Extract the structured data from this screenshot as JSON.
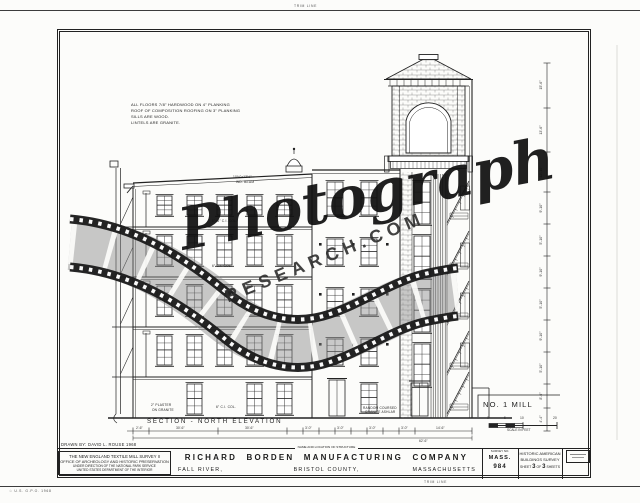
{
  "colors": {
    "ink": "#222222",
    "paper": "#fcfcfa",
    "film_gray": "#8a8a8a"
  },
  "watermark": {
    "script": "Photograph",
    "domain": "RESEARCH.COM"
  },
  "trim": {
    "top_label": "TRIM LINE",
    "bottom_label": "TRIM LINE",
    "printer_note": "☆ U.S. G.P.O. 1968"
  },
  "notes": {
    "line1": "ALL FLOORS 7/8\" HARDWOOD ON 4\" PLANKING",
    "line2": "ROOF OF COMPOSITION ROOFING ON 3\" PLANKING",
    "line3": "SILLS ARE WOOD.",
    "line4": "LINTELS ARE GRANITE."
  },
  "drawing": {
    "section_label": "SECTION - NORTH ELEVATION",
    "mill_label": "NO. 1 MILL",
    "scale": {
      "caption": "SCALE IN FEET",
      "t0": "0",
      "t1": "5",
      "t2": "10",
      "t3": "20"
    },
    "ann": {
      "beam1": "10½\"x13½\"",
      "beam2": "WD. BEAM",
      "col_a": "6\"x6\" C.I. COL.",
      "col_b": "6\" C.I. COL.",
      "col_c": "6\" C.I. COL.",
      "plaster1": "2\" PLASTER",
      "plaster2": "ON GRANITE",
      "ashlar1": "RANDOM COURSED",
      "ashlar2": "GRANITE ASHLAR"
    },
    "dims": {
      "bottom": [
        "2'-6\"",
        "30'-6\"",
        "30'-6\"",
        "3'-0\"",
        "3'-0\"",
        "3'-0\"",
        "3'-0\"",
        "14'-6\""
      ],
      "bottom_total": "62'-6\"",
      "right": [
        "15'-6\"",
        "13'-6\"",
        "12'-10\"",
        "9'-10\"",
        "5'-10\"",
        "9'-10\"",
        "5'-10\"",
        "9'-10\"",
        "5'-10\"",
        "8'-6\"",
        "4'-4\""
      ]
    }
  },
  "titleblock": {
    "drawn_by": "DRAWN BY:  DAVID L. ROUSE  1968",
    "agency": {
      "l1": "THE NEW ENGLAND TEXTILE MILL SURVEY II",
      "l2": "OFFICE OF ARCHEOLOGY AND HISTORIC PRESERVATION",
      "l3": "UNDER DIRECTION OF THE NATIONAL PARK SERVICE",
      "l4": "UNITED STATES DEPARTMENT OF THE INTERIOR"
    },
    "name_header": "NAME AND LOCATION OF STRUCTURE",
    "structure_name": "RICHARD BORDEN MANUFACTURING COMPANY",
    "city": "FALL RIVER,",
    "county": "BRISTOL COUNTY,",
    "state": "MASSACHUSETTS",
    "survey": {
      "header": "SURVEY NO.",
      "state_abbr": "MASS.",
      "number": "984"
    },
    "habs": {
      "l1": "HISTORIC AMERICAN",
      "l2": "BUILDINGS SURVEY",
      "sheet_word": "SHEET",
      "sheet_num": "3",
      "of_word": "OF",
      "sheet_total": "3",
      "sheets_word": "SHEETS"
    }
  }
}
